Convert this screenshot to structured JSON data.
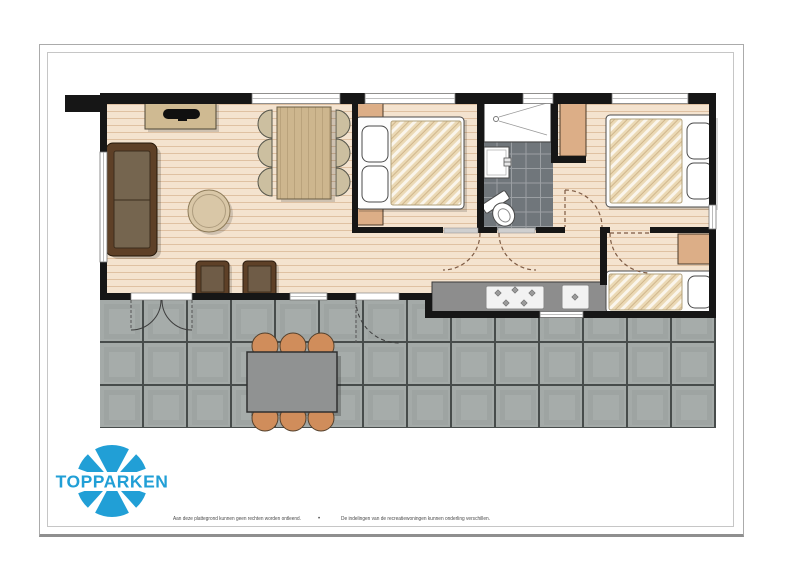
{
  "brand": {
    "wordmark": "TOPPARKEN",
    "logo_color": "#219fd6"
  },
  "footer": {
    "left": "Aan deze plattegrond kunnen geen rechten worden ontleend.",
    "separator": "•",
    "right": "De indelingen van de recreatiewoningen kunnen onderling verschillen."
  },
  "palette": {
    "wall": "#161616",
    "wood_floor": "#f4e3cf",
    "terrace_tile": "#a4aaa8",
    "bathroom_tile": "#70767b",
    "kitchen_counter": "#8d8d8d",
    "cabinet_wood": "#cfba92",
    "wardrobe": "#dcae87",
    "sofa": "#5e4027",
    "mattress": "#ebd9b5",
    "outdoor_chair": "#d08d5b",
    "outdoor_table": "#909292"
  },
  "floorplan": {
    "view": "top-down",
    "rooms": [
      "living-room",
      "dining-area",
      "bedroom-1",
      "bathroom",
      "hall",
      "bedroom-2",
      "bedroom-3",
      "kitchen",
      "terrace"
    ],
    "furniture": [
      "sofa",
      "coffee-table",
      "tv-sideboard",
      "armchair",
      "armchair",
      "dining-table-with-6-chairs",
      "double-bed",
      "double-bed",
      "single-bed",
      "wardrobe",
      "wardrobe",
      "bedside-cabinet",
      "bedside-cabinet",
      "shower",
      "washbasin",
      "toilet",
      "kitchen-counter-with-hob-and-sink",
      "terrace-table-with-6-chairs"
    ]
  }
}
